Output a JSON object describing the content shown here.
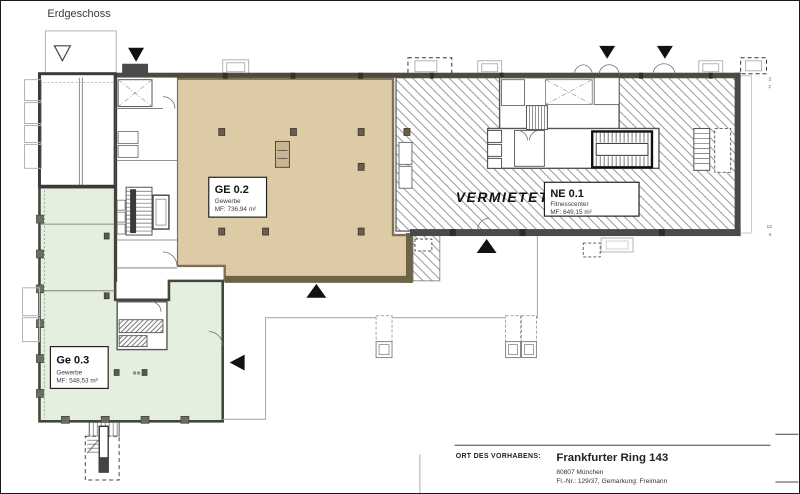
{
  "drawing": {
    "floor_label": "Erdgeschoss",
    "zones": {
      "ge02": {
        "name": "GE 0.2",
        "use": "Gewerbe",
        "area": "MF: 736,94 m²"
      },
      "ne01": {
        "name": "NE 0.1",
        "use": "Fitnesscenter",
        "area": "MF: 649,15 m²"
      },
      "ge03": {
        "name": "Ge 0.3",
        "use": "Gewerbe",
        "area": "MF: 548,53 m²"
      }
    },
    "rented_label": "VERMIETET",
    "grid_marks": {
      "top_a": "2",
      "top_b": "F",
      "bottom_a": "12",
      "bottom_b": "4"
    },
    "colors": {
      "ge02_fill": "#ddcba6",
      "ge03_fill": "#e5efdd",
      "wall": "#3d3d3d"
    }
  },
  "title_block": {
    "label": "ORT DES VORHABENS:",
    "project_title": "Frankfurter Ring 143",
    "address": "80807 München",
    "parcel": "Fl.-Nr.: 129/37, Gemarkung: Freimann"
  }
}
